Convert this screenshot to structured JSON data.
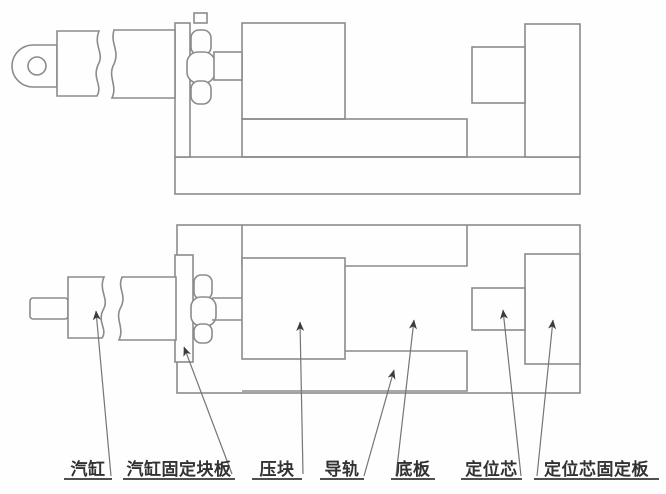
{
  "drawing": {
    "views": [
      "side-elevation",
      "plan"
    ],
    "colors": {
      "background": "#fefefe",
      "outline": "#8b8b8b",
      "leader": "#757575",
      "arrowhead": "#3c3c3c",
      "label_text": "#323232",
      "label_underline": "#4f4f4f"
    }
  },
  "labels": [
    {
      "id": "cylinder",
      "text": "汽缸"
    },
    {
      "id": "cylinder-fixing-block-plate",
      "text": "汽缸固定块板"
    },
    {
      "id": "pressure-block",
      "text": "压块"
    },
    {
      "id": "guide-rail",
      "text": "导轨"
    },
    {
      "id": "base-plate",
      "text": "底板"
    },
    {
      "id": "positioning-core",
      "text": "定位芯"
    },
    {
      "id": "positioning-core-fixing-plate",
      "text": "定位芯固定板"
    }
  ]
}
